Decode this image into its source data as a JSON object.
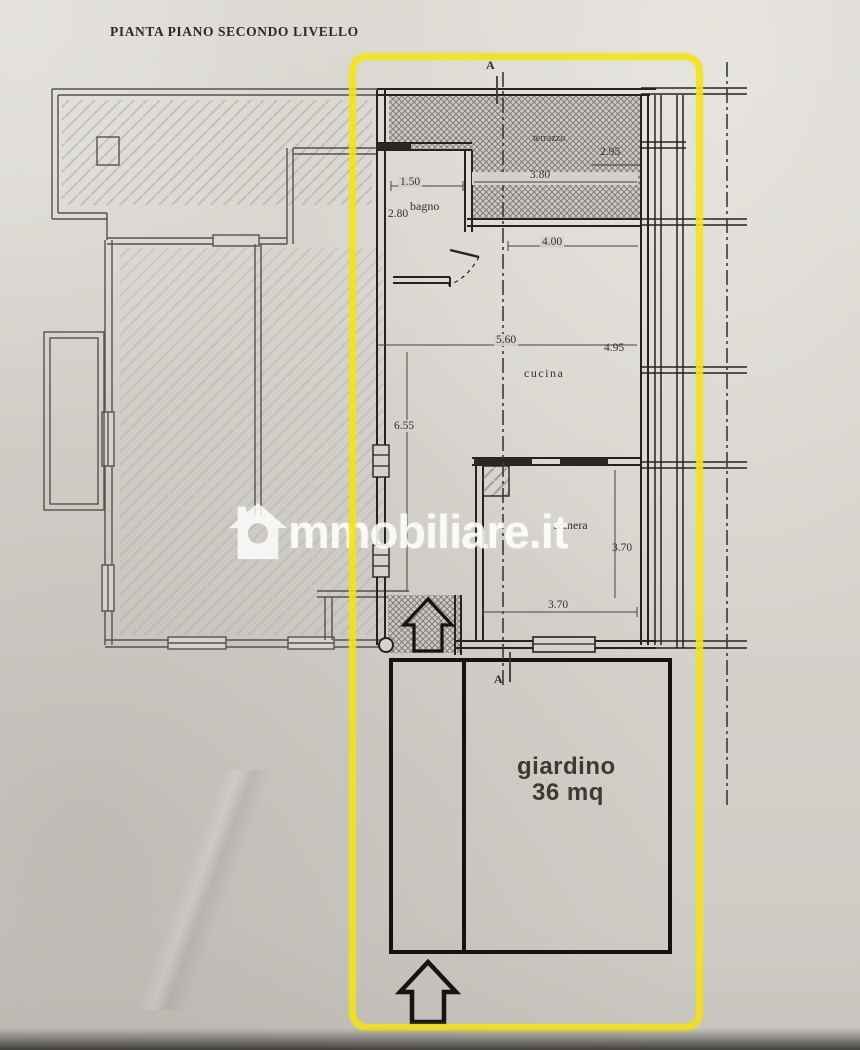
{
  "page": {
    "title": "PIANTA PIANO SECONDO LIVELLO"
  },
  "watermark": {
    "text": "mmobiliare.it"
  },
  "highlight": {
    "color": "#f3e11c",
    "shape": "rounded-rectangle"
  },
  "plan": {
    "section_marker": "A",
    "rooms": {
      "terrazzo": {
        "label": "terrazzo"
      },
      "bagno": {
        "label": "bagno"
      },
      "cucina": {
        "label": "cucina"
      },
      "camera": {
        "label": "camera"
      },
      "giardino": {
        "label": "giardino",
        "area": "36 mq"
      }
    },
    "dimensions": {
      "bagno_width": "1.50",
      "bagno_depth": "2.80",
      "terrazzo_depth": "2.95",
      "terrazzo_width": "3.80",
      "cucina_top_width": "4.00",
      "cucina_width": "5.60",
      "cucina_right_depth": "4.95",
      "living_depth": "6.55",
      "camera_depth": "3.70",
      "camera_width": "3.70"
    }
  }
}
